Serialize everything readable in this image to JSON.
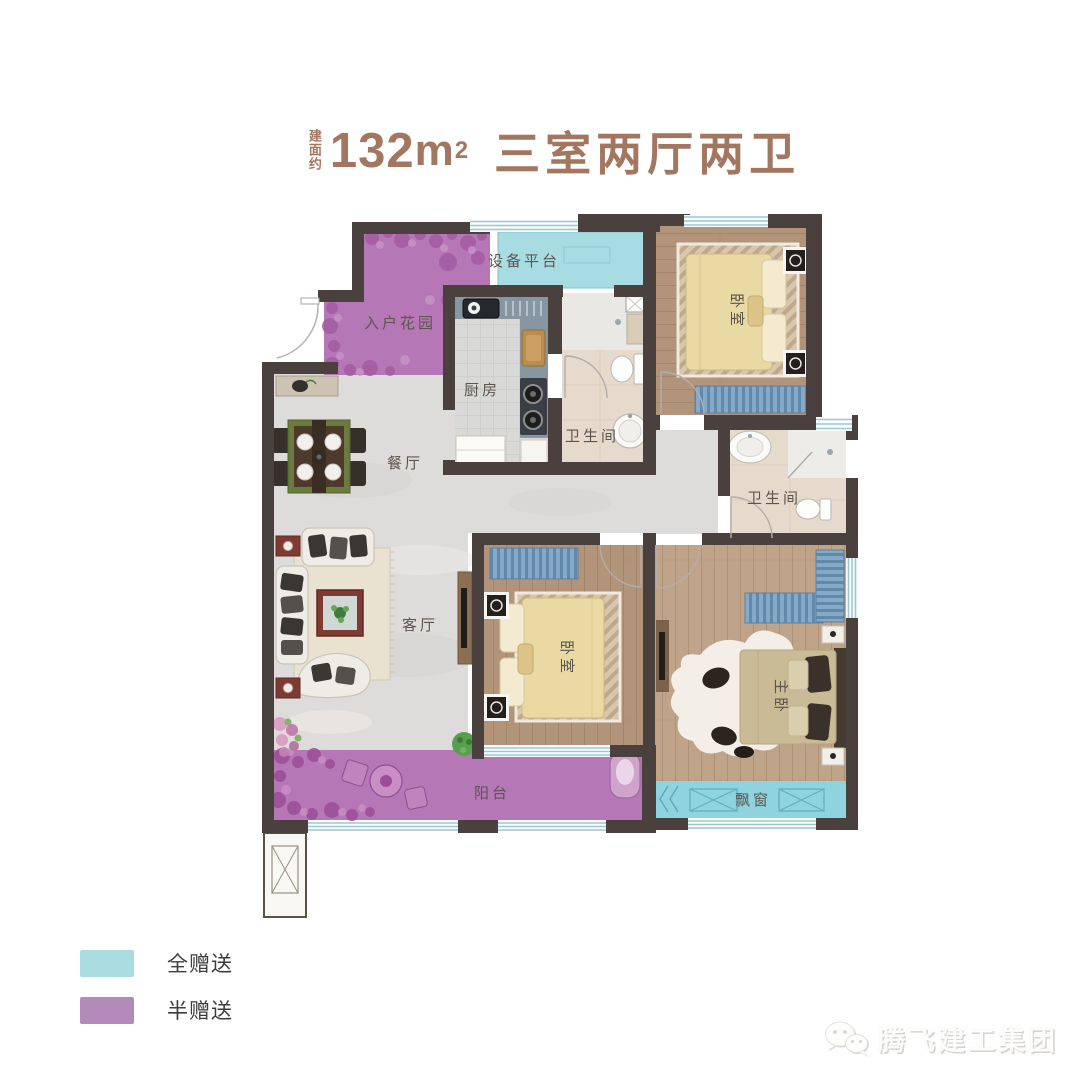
{
  "title": {
    "prefix": "建面约",
    "area_value": "132",
    "area_unit": "m",
    "area_unit_sup": "2",
    "layout_text": "三室两厅两卫",
    "color": "#a3765f"
  },
  "plan": {
    "rooms": {
      "entry_garden": "入户花园",
      "equipment_platform": "设备平台",
      "kitchen": "厨房",
      "bath1": "卫生间",
      "bath2": "卫生间",
      "dining": "餐厅",
      "living": "客厅",
      "bedroom1": "卧室",
      "bedroom2": "卧室",
      "master": "主卧",
      "balcony": "阳台",
      "bay_window": "飘窗"
    },
    "colors": {
      "wall": "#4a403e",
      "full_gift_area": "#a7dce3",
      "half_gift_area": "#b577b5",
      "wood_floor": "#b2947a",
      "marble_floor": "#dedcda"
    }
  },
  "legend": {
    "items": [
      {
        "label": "全赠送",
        "color": "#abdce2"
      },
      {
        "label": "半赠送",
        "color": "#b289b9"
      }
    ]
  },
  "watermark": {
    "brand": "腾飞建工集团",
    "icon": "wechat-icon"
  }
}
